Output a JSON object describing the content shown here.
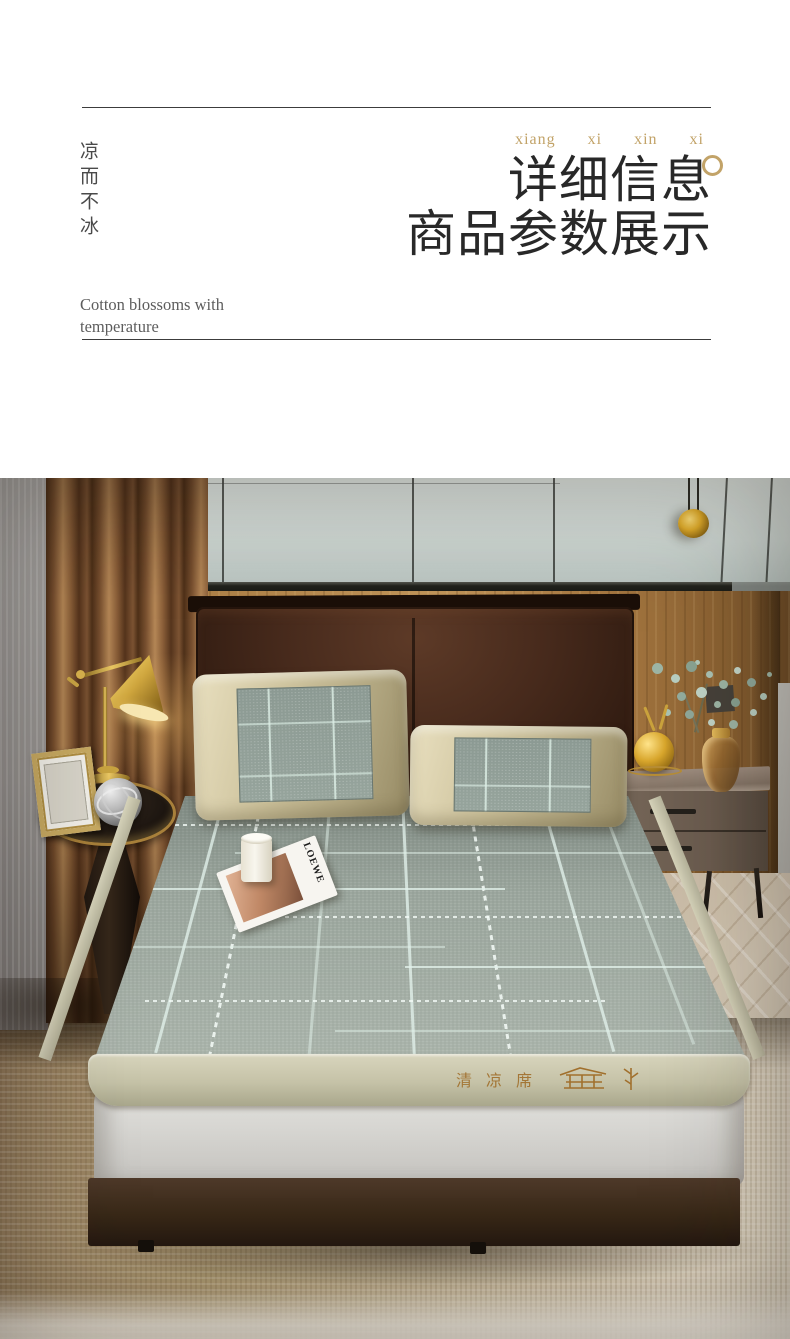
{
  "header": {
    "side_vertical_text": "凉而不冰",
    "pinyin": "xiang xi xin xi",
    "title_line1": "详细信息",
    "title_line2": "商品参数展示",
    "caption_line1": "Cotton blossoms with",
    "caption_line2": "temperature",
    "accent_gold": "#C2A368",
    "title_color": "#282828",
    "rule_color": "#3C3C3C"
  },
  "photo": {
    "mat_embroidery_text": "清凉席",
    "magazine_title": "LOEWE",
    "palette": {
      "wall_panel": "#CFD8D4",
      "wood_wall": "#B28449",
      "curtain_brown": "#8A5E38",
      "curtain_sheer": "#969391",
      "headboard_leather": "#3A2318",
      "mat_base": "#98A39B",
      "mat_pattern_line": "#E2F1EA",
      "mat_border_band": "#C5C2A7",
      "pillow_flange": "#CDC29C",
      "mattress_side": "#D8D7D3",
      "bed_base": "#382817",
      "rug": "#B3A183",
      "floor_planks": "#CBBFAE",
      "brass": "#C9A144",
      "eucalyptus_leaf": "#9DB5A5",
      "embroidery_thread": "#A1702D"
    }
  }
}
